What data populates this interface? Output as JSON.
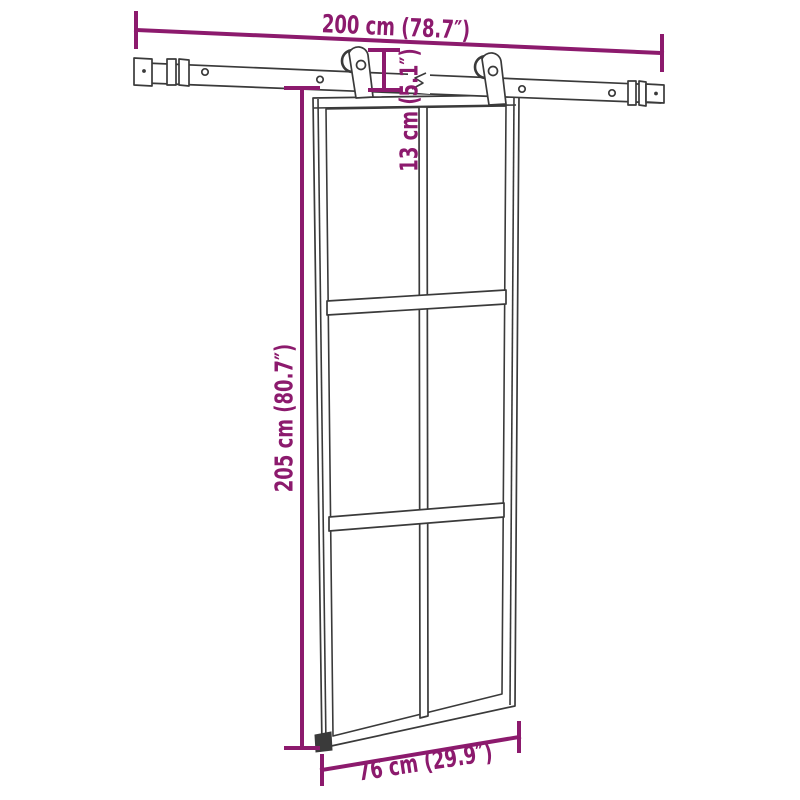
{
  "colors": {
    "dimension": "#8c1a6d",
    "line-art": "#3a3a3a",
    "background": "#ffffff"
  },
  "labels": {
    "rail_width": "200 cm (78.7″)",
    "hanger_height": "13 cm (5.1″)",
    "door_height": "205 cm (80.7″)",
    "door_width": "76 cm (29.9″)"
  }
}
